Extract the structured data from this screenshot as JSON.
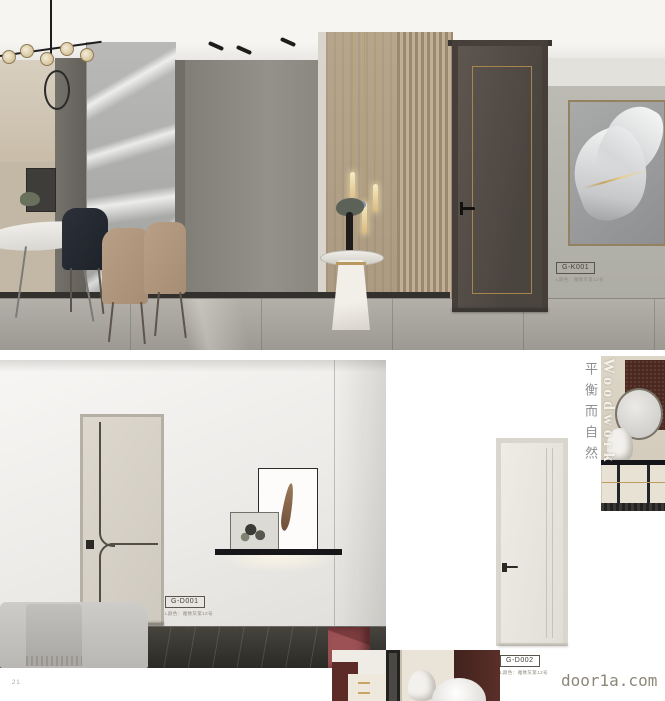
{
  "page": {
    "number": "21",
    "watermark": "door1a.com"
  },
  "products": {
    "k001": {
      "code": "G-K001",
      "spec": "L颜色：雅致灰第12号"
    },
    "d001": {
      "code": "G-D001",
      "spec": "L颜色：雅致灰第12号"
    },
    "d002": {
      "code": "G-D002",
      "spec": "L颜色：雅致灰第12号"
    }
  },
  "right_column": {
    "title_cn": "平衡而自然",
    "title_en": "Woodwork"
  },
  "colors": {
    "accent_gold": "#b08d4f",
    "door_dark": "#57504a",
    "door_cream": "#d8d3c9",
    "door_white": "#e9e7e0",
    "marble_floor_dark": "#34322d",
    "maroon": "#58302a",
    "watermark_text": "#8d8779"
  }
}
